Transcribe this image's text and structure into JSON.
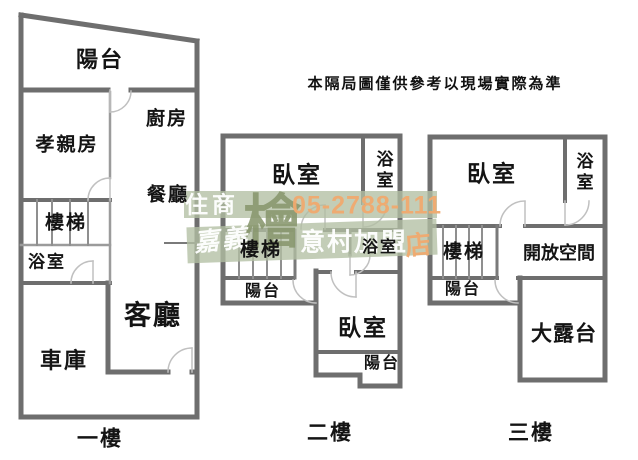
{
  "disclaimer": "本隔局圖僅供參考以現場實際為準",
  "watermark": {
    "brand_line1": "住商",
    "brand_line2": "嘉義",
    "logo_glyph": "檜",
    "phone": "05-2788-111",
    "branch": "意村加盟",
    "branch_suffix": "店"
  },
  "floors": {
    "first": {
      "name": "一樓",
      "rooms": {
        "balcony": "陽台",
        "kitchen": "廚房",
        "parents_room": "孝親房",
        "dining": "餐廳",
        "stairs": "樓梯",
        "bathroom": "浴室",
        "living": "客廳",
        "garage": "車庫"
      }
    },
    "second": {
      "name": "二樓",
      "rooms": {
        "bedroom_top": "臥室",
        "bathroom_top": "浴室",
        "stairs": "樓梯",
        "bathroom_mid": "浴室",
        "balcony_left": "陽台",
        "bedroom_bottom": "臥室",
        "balcony_bottom": "陽台"
      }
    },
    "third": {
      "name": "三樓",
      "rooms": {
        "bedroom": "臥室",
        "bathroom": "浴室",
        "stairs": "樓梯",
        "open_space": "開放空間",
        "balcony": "陽台",
        "terrace": "大露台"
      }
    }
  },
  "colors": {
    "wall": "#6e6e6e",
    "wall_light": "#9b9b9b",
    "door_arc": "#c0c0c0",
    "text": "#141414",
    "watermark_band": "#b2bfa3",
    "watermark_logo": "#87966d",
    "watermark_accent": "#f0a96e"
  }
}
